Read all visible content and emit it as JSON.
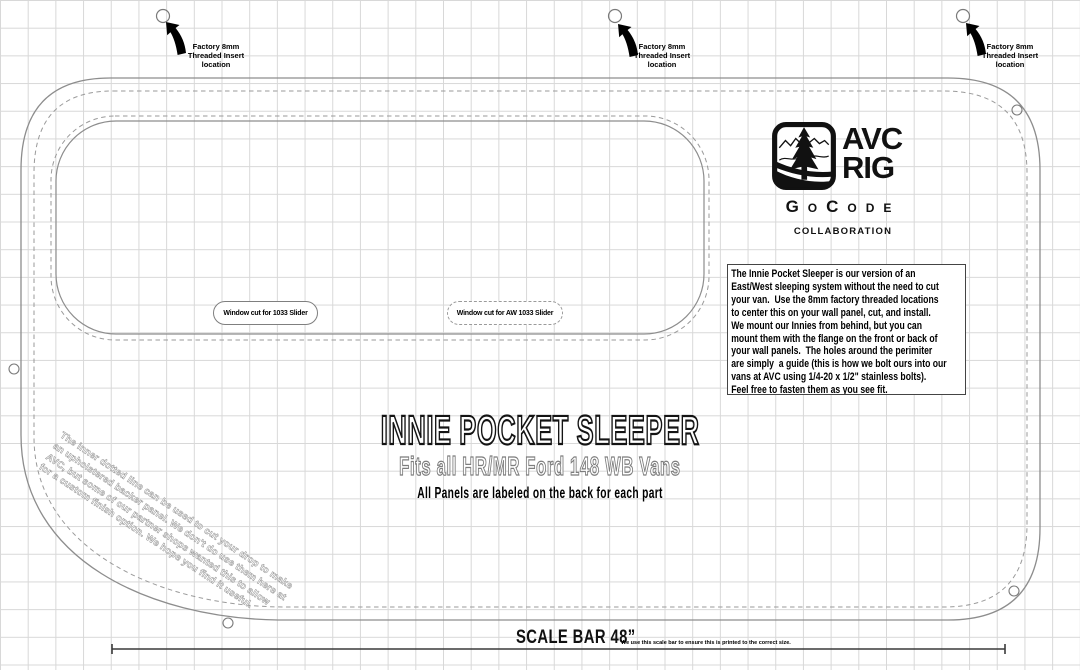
{
  "annotations": {
    "factory_insert_label": "Factory 8mm\nThreaded Insert\nlocation",
    "window_cut_1": "Window cut for 1033 Slider",
    "window_cut_2": "Window cut for AW 1033 Slider",
    "rotated_note": "The inner dotted line can be used to cut your drop to make\nan upholstered backer panel. We don't do use them here at\nAVC, but some of our partner shops wanted this to allow\nfor a custom finish option. We hope you find it useful."
  },
  "logo": {
    "brand_top": "AVC",
    "brand_bottom": "RIG",
    "partner": "GoCode",
    "collaboration": "COLLABORATION"
  },
  "info_box": {
    "text": "The Innie Pocket Sleeper is our version of an\nEast/West sleeping system without the need to cut\nyour van.  Use the 8mm factory threaded locations\nto center this on your wall panel, cut, and install.\nWe mount our Innies from behind, but you can\nmount them with the flange on the front or back of\nyour wall panels.  The holes around the perimiter\nare simply  a guide (this is how we bolt ours into our\nvans at AVC using 1/4-20 x 1/2\" stainless bolts).\nFeel free to fasten them as you see fit."
  },
  "titles": {
    "main": "INNIE POCKET SLEEPER",
    "subtitle": "Fits all HR/MR Ford 148 WB Vans",
    "panels_note": "All Panels are labeled on the back for each part"
  },
  "scale_bar": {
    "label": "SCALE BAR 48”",
    "note": "We use this scale bar to ensure this is printed to the correct size."
  },
  "colors": {
    "cut_line_gray": "#8d8d8d",
    "grid_gray": "#d8d8d8",
    "ink_black": "#111111"
  }
}
